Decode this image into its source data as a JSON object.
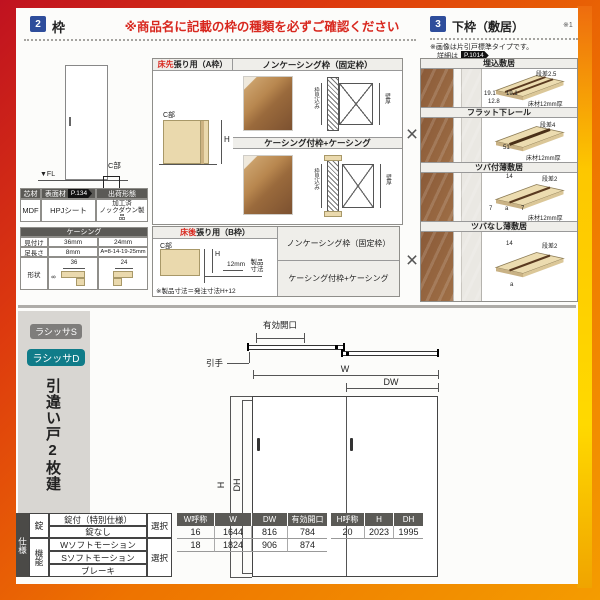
{
  "section_waku": {
    "num": "2",
    "title": "枠",
    "warning": "※商品名に記載の枠の種類を必ずご確認ください",
    "door_diagram": {
      "fl_label": "▼FL",
      "c_label": "C部"
    },
    "materials_table": {
      "headers": [
        "芯材",
        "表面材",
        "出荷形態"
      ],
      "page_badge": "P.134",
      "values": [
        "MDF",
        "HPJシート",
        "加工済\nノックダウン製品"
      ]
    },
    "casing_table": {
      "title": "ケーシング",
      "row1": {
        "label": "見付け",
        "v1": "36mm",
        "v2": "24mm"
      },
      "row2": {
        "label": "足長さ",
        "v1": "8mm",
        "v2": "A=8-14-19-25mm"
      },
      "shape_label": "形状",
      "dim1": "36",
      "dim2": "24",
      "side1": "8"
    },
    "a_frame": {
      "title_red": "床先",
      "title_rest": "張り用（A枠）",
      "noncasing_header": "ノンケーシング枠（固定枠）",
      "casing_header": "ケーシング付枠+ケーシング",
      "c_label": "C部",
      "h_label": "H",
      "depth_label": "枠見込み",
      "wall_label": "壁厚"
    },
    "b_frame": {
      "title_red": "床後",
      "title_rest": "張り用（B枠）",
      "c_label": "C部",
      "h_label": "H",
      "dim12": "12mm",
      "product_dim": "製品寸法",
      "note": "※製品寸法＝発注寸法H+12",
      "noncasing_header": "ノンケーシング枠（固定枠）",
      "casing_header": "ケーシング付枠+ケーシング"
    },
    "cross_mark": "×"
  },
  "section_shikii": {
    "num": "3",
    "title": "下枠（敷居）",
    "ref_mark": "※1",
    "note_line1": "※画像は片引戸標準タイプです。",
    "note_line2_prefix": "詳細は",
    "note_badge": "P.1014",
    "rows": [
      {
        "name": "埋込敷居",
        "step": "段差2.5",
        "d1": "19.1",
        "d2": "19.1",
        "d3": "12.8",
        "floor": "床材12mm厚"
      },
      {
        "name": "フラット下レール",
        "step": "段差4",
        "d1": "51",
        "floor": "床材12mm厚"
      },
      {
        "name": "ツバ付薄敷居",
        "top": "14",
        "step": "段差2",
        "d1": "7",
        "d2": "a",
        "d3": "7",
        "floor": "床材12mm厚"
      },
      {
        "name": "ツバなし薄敷居",
        "top": "14",
        "step": "段差2",
        "d1": "a"
      }
    ]
  },
  "product_section": {
    "badge_s": "ラシッサS",
    "badge_d": "ラシッサD",
    "product_title": "引違い戸2枚建",
    "diagram": {
      "opening_label": "有効開口",
      "handle_label": "引手",
      "w": "W",
      "dw": "DW",
      "h": "H",
      "dh": "DH"
    },
    "spec_table": {
      "group": "仕様",
      "lock_label": "錠",
      "func_label": "機能",
      "lock_rows": [
        "錠付（特別仕様）",
        "錠なし"
      ],
      "func_rows": [
        "Wソフトモーション",
        "Sソフトモーション",
        "ブレーキ"
      ],
      "select1": "選択",
      "select2": "選択"
    },
    "w_table": {
      "headers": [
        "W呼称",
        "W",
        "DW",
        "有効開口"
      ],
      "rows": [
        [
          "16",
          "1644",
          "816",
          "784"
        ],
        [
          "18",
          "1824",
          "906",
          "874"
        ]
      ]
    },
    "h_table": {
      "headers": [
        "H呼称",
        "H",
        "DH"
      ],
      "rows": [
        [
          "20",
          "2023",
          "1995"
        ]
      ]
    }
  }
}
